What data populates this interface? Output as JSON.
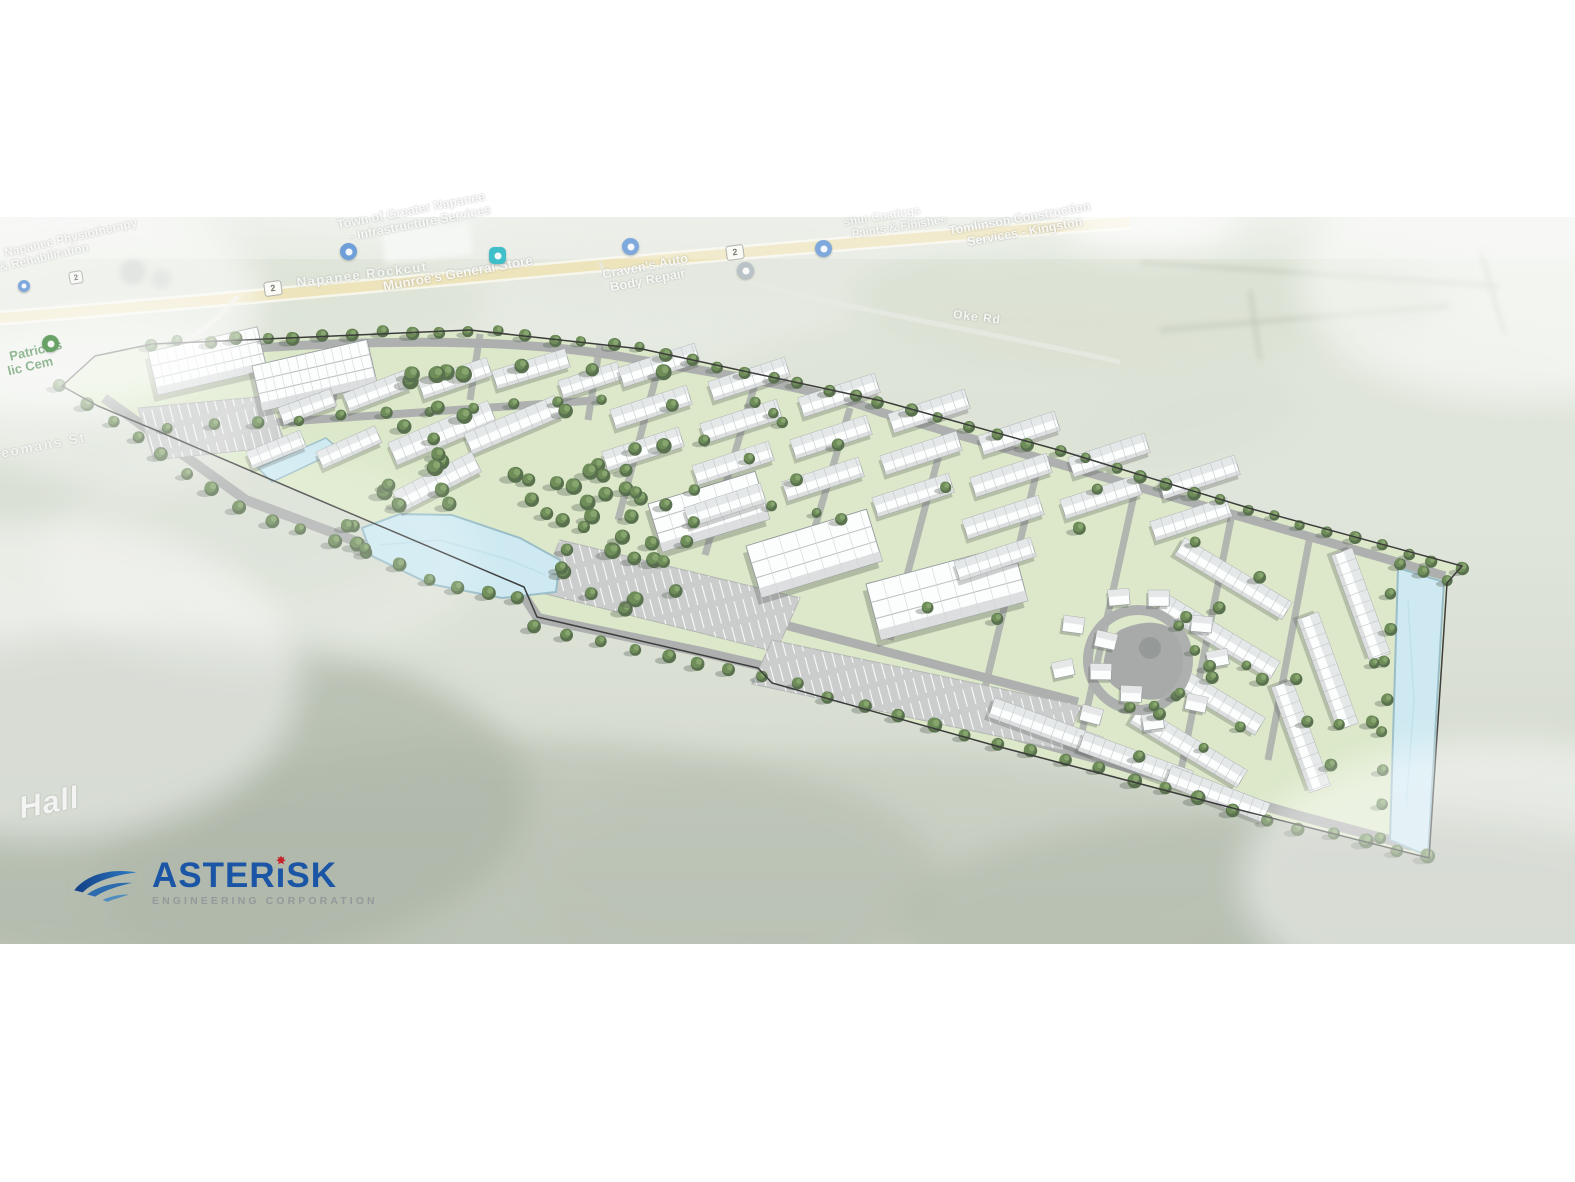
{
  "title": "Aerial site plan rendering",
  "logo": {
    "name_full": "ASTERISK",
    "name_pre": "ASTER",
    "name_i": "ı",
    "name_post": "SK",
    "subtitle": "ENGINEERING CORPORATION",
    "colors": {
      "blue": "#1a55a6",
      "red": "#c6222b",
      "gray": "#94999d"
    }
  },
  "map_labels": {
    "physio_1": "Napanee Physiotherapy",
    "physio_2": "& Rehabilitation",
    "infra_1": "Town of Greater Napanee",
    "infra_2": "- Infrastructure Services",
    "rockcut": "Napanee Rockcut",
    "munroes": "Munroe's General Store",
    "cravens_1": "Craven's Auto",
    "cravens_2": "Body Repair",
    "coatings_1": "shur Coatings",
    "coatings_2": "Paints & Finishes",
    "tomlinson_1": "Tomlinson Construction",
    "tomlinson_2": "Services - Kingston",
    "oke_rd": "Oke Rd",
    "cemetery_1": "Patrick's",
    "cemetery_2": "lic Cem",
    "yeomans": "eomans St",
    "hall": "Hall"
  },
  "road_shields": {
    "a": "2",
    "b": "2",
    "c": "2"
  },
  "map_pins": [
    {
      "name": "map-pin-infrastructure",
      "color": "#6f9fd8"
    },
    {
      "name": "map-pin-general-store",
      "color": "#3fbfc9"
    },
    {
      "name": "map-pin-auto-body",
      "color": "#7fa9dc"
    },
    {
      "name": "map-pin-gray-place",
      "color": "#b9c2c6"
    },
    {
      "name": "map-pin-coatings",
      "color": "#7fa9dc"
    },
    {
      "name": "map-pin-left-edge",
      "color": "#7fa9dc"
    },
    {
      "name": "map-pin-cemetery",
      "color": "#69a266"
    }
  ],
  "scene": {
    "colors": {
      "site_green": "#d8e6c3",
      "lawn": "#cfe0b4",
      "road": "#a4a8a5",
      "road_light": "#b9bdba",
      "parking": "#c5c8c7",
      "water": "#c9e7f0",
      "water_edge": "#8fb6c1",
      "tree_dark": "#47613a",
      "tree_mid": "#5e8047",
      "tree_light": "#7a9c5e",
      "building": "#fcfdfd",
      "building_shade": "#d8dbdc",
      "boundary": "#262626",
      "highway": "#eadfae",
      "highway_casing": "#f7f5ea"
    }
  }
}
